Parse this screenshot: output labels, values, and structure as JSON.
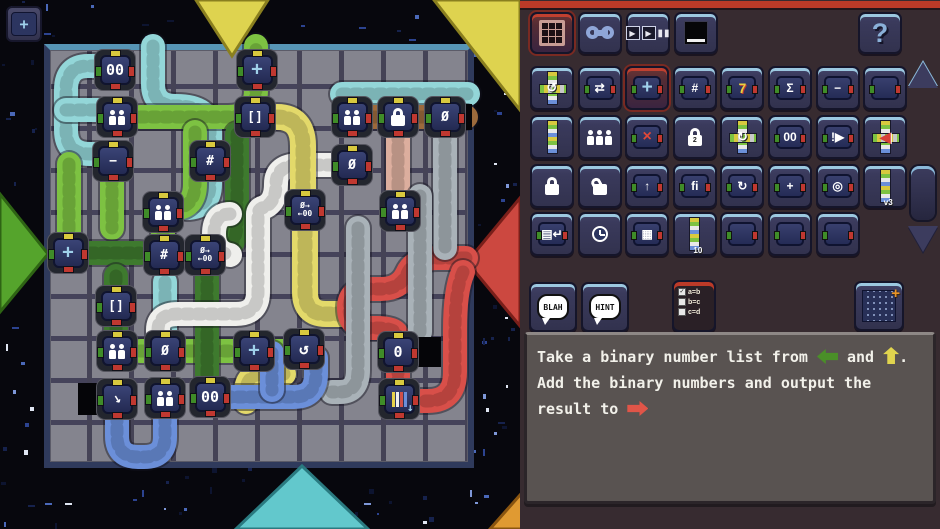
{
  "window": {
    "width": 940,
    "height": 529
  },
  "toolbar": {
    "buttons": [
      {
        "name": "module-palette",
        "icon": "grid3",
        "selected": true
      },
      {
        "name": "tools",
        "icon": "wrench",
        "selected": false
      },
      {
        "name": "run-controls",
        "icon": "playpause",
        "selected": false
      },
      {
        "name": "screen-view",
        "icon": "blackbox",
        "selected": false
      }
    ],
    "help_label": "?"
  },
  "palette": {
    "rows": [
      [
        {
          "name": "wire-loop",
          "kind": "wireloop",
          "glyph": "↺"
        },
        {
          "name": "swap-values",
          "kind": "tile",
          "glyph": "⇄"
        },
        {
          "name": "add-module",
          "kind": "tile",
          "glyph": "+",
          "cls": "glyph-cross",
          "selected": true
        },
        {
          "name": "count-module",
          "kind": "tile",
          "glyph": "#"
        },
        {
          "name": "constant-seven",
          "kind": "tile",
          "glyph": "7",
          "cls": "seven"
        },
        {
          "name": "sum-module",
          "kind": "tile",
          "glyph": "Σ"
        },
        {
          "name": "subtract-module",
          "kind": "tile",
          "glyph": "−"
        },
        {
          "name": "blank-module",
          "kind": "tile",
          "glyph": ""
        }
      ],
      [
        {
          "name": "wire-straight",
          "kind": "wire"
        },
        {
          "name": "workers",
          "kind": "people",
          "n": 3
        },
        {
          "name": "delete-module",
          "kind": "tile",
          "glyph": "×",
          "cls": "del"
        },
        {
          "name": "lock-2",
          "kind": "lock",
          "num": "2"
        },
        {
          "name": "wire-loop-2",
          "kind": "wireloop",
          "glyph": "↻"
        },
        {
          "name": "double-zero",
          "kind": "tile",
          "glyph": "00"
        },
        {
          "name": "alert-module",
          "kind": "tile",
          "glyph": "!▶"
        },
        {
          "name": "read-bit-wire",
          "kind": "readbit",
          "glyph": "◀"
        }
      ],
      [
        {
          "name": "lock-closed",
          "kind": "lock"
        },
        {
          "name": "lock-open",
          "kind": "lock",
          "open": true
        },
        {
          "name": "push-up-module",
          "kind": "tile",
          "glyph": "↑"
        },
        {
          "name": "flag-bars-module",
          "kind": "tile",
          "glyph": "fi"
        },
        {
          "name": "cycle-module",
          "kind": "tile",
          "glyph": "↻"
        },
        {
          "name": "plus-white-module",
          "kind": "tile",
          "glyph": "+"
        },
        {
          "name": "spiral-module",
          "kind": "tile",
          "glyph": "◎"
        },
        {
          "name": "wire-v3",
          "kind": "wire",
          "label": "v3"
        }
      ],
      [
        {
          "name": "screen-enter-module",
          "kind": "tile",
          "glyph": "▤↵"
        },
        {
          "name": "clock-module",
          "kind": "clock"
        },
        {
          "name": "screen-module",
          "kind": "tile",
          "glyph": "▦"
        },
        {
          "name": "bit-list-wire",
          "kind": "wire",
          "label": "10"
        },
        {
          "name": "blank-module",
          "kind": "tile",
          "glyph": ""
        },
        {
          "name": "blank-module",
          "kind": "tile",
          "glyph": ""
        },
        {
          "name": "blank-module",
          "kind": "tile",
          "glyph": ""
        }
      ]
    ],
    "version_label": "v3"
  },
  "hint_buttons": {
    "blah": "BLAH",
    "hint": "HINT"
  },
  "checklist": {
    "items": [
      {
        "checked": true,
        "label": "a=b"
      },
      {
        "checked": false,
        "label": "b=c"
      },
      {
        "checked": false,
        "label": "c=d"
      }
    ]
  },
  "instruction": {
    "parts": [
      {
        "type": "text",
        "value": "Take a binary number list from "
      },
      {
        "type": "arrow",
        "dir": "left",
        "color": "#4a8f28"
      },
      {
        "type": "text",
        "value": " and "
      },
      {
        "type": "arrow",
        "dir": "up",
        "color": "#e0d44e"
      },
      {
        "type": "text",
        "value": "."
      },
      {
        "type": "break"
      },
      {
        "type": "text",
        "value": "Add the binary numbers and output the"
      },
      {
        "type": "break"
      },
      {
        "type": "text",
        "value": "result to "
      },
      {
        "type": "arrow",
        "dir": "right",
        "color": "#e05548"
      }
    ]
  },
  "board": {
    "ports": [
      {
        "name": "port-top-yellow",
        "points": "196,0 268,0 232,56",
        "fill": "#ded34f",
        "stroke": "#8a7f1f"
      },
      {
        "name": "port-corner-yellow",
        "points": "434,0 520,0 520,110",
        "fill": "#ded34f",
        "stroke": "#8a7f1f"
      },
      {
        "name": "port-left-green",
        "points": "0,194 48,254 0,312",
        "fill": "#55a42c",
        "stroke": "#2e6414"
      },
      {
        "name": "port-right-red",
        "points": "520,198 467,262 520,326",
        "fill": "#cc4840",
        "stroke": "#7a1f1a"
      },
      {
        "name": "port-bottom-teal",
        "points": "236,529 302,466 368,529",
        "fill": "#62c8cc",
        "stroke": "#2a7a80"
      },
      {
        "name": "port-bottom-orange",
        "points": "490,529 535,478 580,529",
        "fill": "#e09a32",
        "stroke": "#8a5510"
      }
    ],
    "black_cells": [
      {
        "x": 78,
        "y": 383,
        "w": 26,
        "h": 32
      },
      {
        "x": 415,
        "y": 337,
        "w": 26,
        "h": 30
      },
      {
        "x": 460,
        "y": 104,
        "w": 12,
        "h": 26
      }
    ],
    "cables": [
      {
        "color": "#93d6d8",
        "path": "M120,66 H88 Q66,66 66,90 V130 Q66,154 90,154 H120"
      },
      {
        "color": "#93d6d8",
        "path": "M66,110 H98"
      },
      {
        "color": "#93d6d8",
        "path": "M153,46 V84 Q153,106 176,106 Q210,106 210,130 V184 Q210,208 186,208"
      },
      {
        "color": "#93d6d8",
        "path": "M342,94 H468"
      },
      {
        "color": "#93d6d8",
        "path": "M165,282 V332"
      },
      {
        "color": "#7dc242",
        "path": "M140,117 H228 Q256,117 256,90 V46"
      },
      {
        "color": "#7dc242",
        "path": "M195,132 V184 Q195,206 177,208"
      },
      {
        "color": "#7dc242",
        "path": "M69,164 V234"
      },
      {
        "color": "#7dc242",
        "path": "M112,166 V228"
      },
      {
        "color": "#7dc242",
        "path": "M163,228 V240"
      },
      {
        "color": "#7dc242",
        "path": "M140,351 H284"
      },
      {
        "color": "#3e7a2e",
        "path": "M237,134 V222 Q237,244 224,250"
      },
      {
        "color": "#3e7a2e",
        "path": "M207,273 V380"
      },
      {
        "color": "#3e7a2e",
        "path": "M90,253 H140"
      },
      {
        "color": "#3e7a2e",
        "path": "M116,276 V330"
      },
      {
        "color": "#efefec",
        "path": "M332,165 H300 Q276,165 276,184 Q276,204 262,208 Q258,210 258,214 V292 Q258,314 236,314 H178 Q158,314 158,330 V334"
      },
      {
        "color": "#efefec",
        "path": "M230,214 Q214,214 214,234 Q214,252 230,255"
      },
      {
        "color": "#e3d96a",
        "path": "M277,117 Q303,117 303,146 V190",
        "w": 26
      },
      {
        "color": "#e3d96a",
        "path": "M305,230 V292 Q305,314 326,314 H356",
        "w": 26
      },
      {
        "color": "#e3d96a",
        "path": "M284,374 H264 Q246,374 246,392 V402",
        "w": 24
      },
      {
        "color": "#d84f49",
        "path": "M466,258 H438 Q414,258 407,274 Q400,289 381,289 H370 Q349,289 349,308 Q349,328 370,328 H377 Q398,328 398,338"
      },
      {
        "color": "#d84f49",
        "path": "M463,272 Q455,290 455,330 V372 Q455,401 428,401 H421"
      },
      {
        "color": "#d84f49",
        "path": "M398,368 V382"
      },
      {
        "color": "#dcae9e",
        "path": "M398,134 V194"
      },
      {
        "color": "#a9b2b8",
        "path": "M445,134 V248"
      },
      {
        "color": "#a9b2b8",
        "path": "M420,196 V332"
      },
      {
        "color": "#a9b2b8",
        "path": "M358,228 V370 Q358,392 340,392 H332"
      },
      {
        "color": "#9c6a3c",
        "path": "M370,117 H466"
      },
      {
        "color": "#6b8fd9",
        "path": "M226,397 H294 Q316,397 316,374 V358"
      },
      {
        "color": "#6b8fd9",
        "path": "M117,416 V436 Q117,457 138,457 H144 Q165,457 165,437 V416"
      },
      {
        "color": "#6b8fd9",
        "path": "M272,353 V390"
      }
    ],
    "modules": [
      {
        "x": 115,
        "y": 70,
        "kind": "text",
        "glyph": "00",
        "cls": "glyph-zero",
        "name": "counter-00"
      },
      {
        "x": 117,
        "y": 117,
        "kind": "people",
        "n": 2,
        "name": "workers"
      },
      {
        "x": 113,
        "y": 161,
        "kind": "text",
        "glyph": "−",
        "name": "subtract"
      },
      {
        "x": 210,
        "y": 161,
        "kind": "text",
        "glyph": "#",
        "name": "count"
      },
      {
        "x": 257,
        "y": 70,
        "kind": "text",
        "glyph": "+",
        "cls": "glyph-cross",
        "name": "add"
      },
      {
        "x": 255,
        "y": 117,
        "kind": "text",
        "glyph": "[]",
        "name": "list"
      },
      {
        "x": 352,
        "y": 117,
        "kind": "people",
        "n": 2,
        "name": "workers"
      },
      {
        "x": 398,
        "y": 117,
        "kind": "lock",
        "name": "lock"
      },
      {
        "x": 445,
        "y": 117,
        "kind": "text",
        "glyph": "Ø",
        "name": "null"
      },
      {
        "x": 352,
        "y": 165,
        "kind": "text",
        "glyph": "Ø",
        "name": "null"
      },
      {
        "x": 163,
        "y": 212,
        "kind": "people",
        "n": 2,
        "name": "workers"
      },
      {
        "x": 68,
        "y": 253,
        "kind": "text",
        "glyph": "+",
        "cls": "glyph-cross",
        "name": "input-module"
      },
      {
        "x": 164,
        "y": 255,
        "kind": "text",
        "glyph": "#",
        "name": "count"
      },
      {
        "x": 205,
        "y": 255,
        "kind": "swap",
        "name": "null-to-00"
      },
      {
        "x": 305,
        "y": 210,
        "kind": "swap",
        "name": "null-to-00"
      },
      {
        "x": 400,
        "y": 211,
        "kind": "people",
        "n": 2,
        "name": "workers"
      },
      {
        "x": 116,
        "y": 306,
        "kind": "text",
        "glyph": "[]",
        "name": "list"
      },
      {
        "x": 117,
        "y": 351,
        "kind": "people",
        "n": 2,
        "name": "workers"
      },
      {
        "x": 165,
        "y": 351,
        "kind": "text",
        "glyph": "Ø",
        "name": "null"
      },
      {
        "x": 254,
        "y": 351,
        "kind": "text",
        "glyph": "+",
        "cls": "glyph-cross",
        "name": "add"
      },
      {
        "x": 304,
        "y": 349,
        "kind": "text",
        "glyph": "↺",
        "cls": "glyph-loop",
        "name": "loop"
      },
      {
        "x": 398,
        "y": 352,
        "kind": "text",
        "glyph": "0",
        "cls": "glyph-zero",
        "name": "zero"
      },
      {
        "x": 117,
        "y": 399,
        "kind": "pointer",
        "name": "pointer"
      },
      {
        "x": 165,
        "y": 398,
        "kind": "people",
        "n": 2,
        "name": "workers"
      },
      {
        "x": 210,
        "y": 397,
        "kind": "text",
        "glyph": "00",
        "cls": "glyph-zero",
        "name": "counter-00"
      },
      {
        "x": 399,
        "y": 399,
        "kind": "bars",
        "name": "output-list"
      }
    ]
  },
  "colors": {
    "panel_bg": "#372b30",
    "panel_topbar": "#bc3a28",
    "board_bg": "#84848e",
    "board_groove": "#454356",
    "space_bg": "#07070d"
  }
}
